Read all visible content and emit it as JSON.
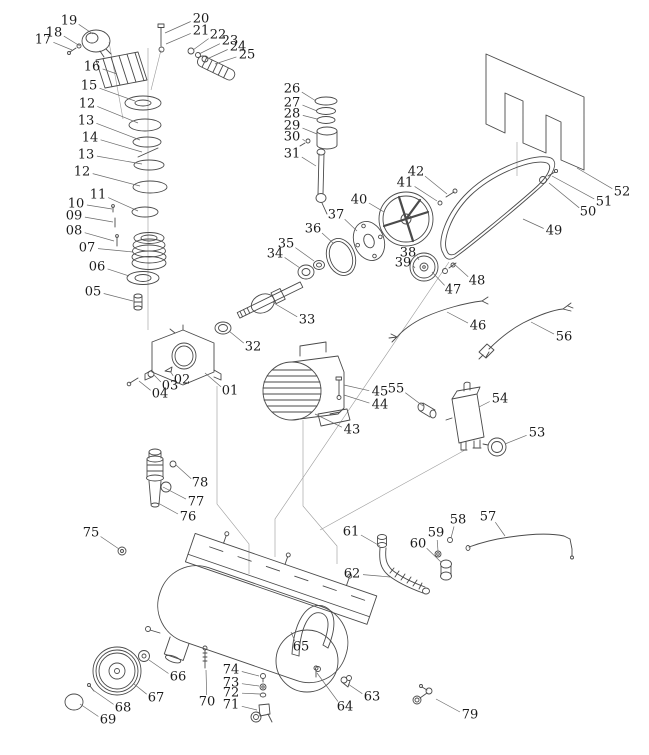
{
  "diagram": {
    "type": "exploded-parts-diagram",
    "subject": "air-compressor",
    "colors": {
      "background": "#ffffff",
      "line": "#4a4a4a",
      "construction": "#9a9a9a",
      "leader": "#6a6a6a",
      "label": "#1b1b1b"
    },
    "labels": [
      {
        "n": "17",
        "x": 43,
        "y": 40,
        "tx": 72,
        "ty": 50
      },
      {
        "n": "18",
        "x": 54,
        "y": 33,
        "tx": 80,
        "ty": 46
      },
      {
        "n": "19",
        "x": 69,
        "y": 21,
        "tx": 93,
        "ty": 34
      },
      {
        "n": "20",
        "x": 201,
        "y": 19,
        "tx": 165,
        "ty": 33
      },
      {
        "n": "21",
        "x": 201,
        "y": 31,
        "tx": 166,
        "ty": 44
      },
      {
        "n": "22",
        "x": 218,
        "y": 35,
        "tx": 193,
        "ty": 50
      },
      {
        "n": "23",
        "x": 230,
        "y": 41,
        "tx": 199,
        "ty": 54
      },
      {
        "n": "24",
        "x": 238,
        "y": 47,
        "tx": 207,
        "ty": 59
      },
      {
        "n": "25",
        "x": 247,
        "y": 55,
        "tx": 215,
        "ty": 64
      },
      {
        "n": "16",
        "x": 92,
        "y": 67,
        "tx": 117,
        "ty": 74
      },
      {
        "n": "15",
        "x": 89,
        "y": 86,
        "tx": 135,
        "ty": 101
      },
      {
        "n": "12",
        "x": 87,
        "y": 104,
        "tx": 138,
        "ty": 123
      },
      {
        "n": "13",
        "x": 86,
        "y": 121,
        "tx": 140,
        "ty": 140
      },
      {
        "n": "14",
        "x": 90,
        "y": 138,
        "tx": 142,
        "ty": 152
      },
      {
        "n": "13",
        "x": 86,
        "y": 155,
        "tx": 142,
        "ty": 164
      },
      {
        "n": "12",
        "x": 82,
        "y": 172,
        "tx": 140,
        "ty": 186
      },
      {
        "n": "11",
        "x": 98,
        "y": 195,
        "tx": 138,
        "ty": 211
      },
      {
        "n": "10",
        "x": 76,
        "y": 204,
        "tx": 112,
        "ty": 209
      },
      {
        "n": "09",
        "x": 74,
        "y": 216,
        "tx": 113,
        "ty": 222
      },
      {
        "n": "08",
        "x": 74,
        "y": 231,
        "tx": 114,
        "ty": 241
      },
      {
        "n": "07",
        "x": 87,
        "y": 248,
        "tx": 133,
        "ty": 252
      },
      {
        "n": "06",
        "x": 97,
        "y": 267,
        "tx": 129,
        "ty": 276
      },
      {
        "n": "05",
        "x": 93,
        "y": 292,
        "tx": 133,
        "ty": 301
      },
      {
        "n": "26",
        "x": 292,
        "y": 89,
        "tx": 316,
        "ty": 101
      },
      {
        "n": "27",
        "x": 292,
        "y": 103,
        "tx": 317,
        "ty": 111
      },
      {
        "n": "28",
        "x": 292,
        "y": 114,
        "tx": 317,
        "ty": 119
      },
      {
        "n": "29",
        "x": 292,
        "y": 126,
        "tx": 317,
        "ty": 134
      },
      {
        "n": "30",
        "x": 292,
        "y": 137,
        "tx": 305,
        "ty": 141
      },
      {
        "n": "31",
        "x": 292,
        "y": 154,
        "tx": 316,
        "ty": 166
      },
      {
        "n": "40",
        "x": 359,
        "y": 200,
        "tx": 384,
        "ty": 212
      },
      {
        "n": "41",
        "x": 405,
        "y": 183,
        "tx": 437,
        "ty": 201
      },
      {
        "n": "42",
        "x": 416,
        "y": 172,
        "tx": 447,
        "ty": 194
      },
      {
        "n": "37",
        "x": 336,
        "y": 215,
        "tx": 357,
        "ty": 231
      },
      {
        "n": "36",
        "x": 313,
        "y": 229,
        "tx": 333,
        "ty": 243
      },
      {
        "n": "35",
        "x": 286,
        "y": 244,
        "tx": 314,
        "ty": 261
      },
      {
        "n": "34",
        "x": 275,
        "y": 254,
        "tx": 300,
        "ty": 268
      },
      {
        "n": "33",
        "x": 307,
        "y": 320,
        "tx": 272,
        "ty": 302
      },
      {
        "n": "38",
        "x": 408,
        "y": 253,
        "tx": 419,
        "ty": 260
      },
      {
        "n": "39",
        "x": 403,
        "y": 263,
        "tx": 415,
        "ty": 268
      },
      {
        "n": "32",
        "x": 253,
        "y": 347,
        "tx": 229,
        "ty": 331
      },
      {
        "n": "50",
        "x": 588,
        "y": 212,
        "tx": 549,
        "ty": 183
      },
      {
        "n": "51",
        "x": 604,
        "y": 202,
        "tx": 552,
        "ty": 176
      },
      {
        "n": "52",
        "x": 622,
        "y": 192,
        "tx": 577,
        "ty": 168
      },
      {
        "n": "49",
        "x": 554,
        "y": 231,
        "tx": 523,
        "ty": 219
      },
      {
        "n": "48",
        "x": 477,
        "y": 281,
        "tx": 453,
        "ty": 263
      },
      {
        "n": "47",
        "x": 453,
        "y": 290,
        "tx": 432,
        "ty": 272
      },
      {
        "n": "46",
        "x": 478,
        "y": 326,
        "tx": 447,
        "ty": 312
      },
      {
        "n": "56",
        "x": 564,
        "y": 337,
        "tx": 531,
        "ty": 322
      },
      {
        "n": "45",
        "x": 380,
        "y": 392,
        "tx": 344,
        "ty": 385
      },
      {
        "n": "55",
        "x": 396,
        "y": 389,
        "tx": 423,
        "ty": 406
      },
      {
        "n": "44",
        "x": 380,
        "y": 405,
        "tx": 344,
        "ty": 395
      },
      {
        "n": "43",
        "x": 352,
        "y": 430,
        "tx": 315,
        "ty": 414
      },
      {
        "n": "54",
        "x": 500,
        "y": 399,
        "tx": 479,
        "ty": 407
      },
      {
        "n": "53",
        "x": 537,
        "y": 433,
        "tx": 505,
        "ty": 444
      },
      {
        "n": "01",
        "x": 230,
        "y": 391,
        "tx": 205,
        "ty": 373
      },
      {
        "n": "02",
        "x": 182,
        "y": 380,
        "tx": 170,
        "ty": 371
      },
      {
        "n": "03",
        "x": 170,
        "y": 386,
        "tx": 154,
        "ty": 375
      },
      {
        "n": "04",
        "x": 160,
        "y": 394,
        "tx": 139,
        "ty": 381
      },
      {
        "n": "78",
        "x": 200,
        "y": 483,
        "tx": 176,
        "ty": 465
      },
      {
        "n": "77",
        "x": 196,
        "y": 502,
        "tx": 163,
        "ty": 487
      },
      {
        "n": "76",
        "x": 188,
        "y": 517,
        "tx": 158,
        "ty": 503
      },
      {
        "n": "75",
        "x": 91,
        "y": 533,
        "tx": 119,
        "ty": 549
      },
      {
        "n": "61",
        "x": 351,
        "y": 532,
        "tx": 380,
        "ty": 546
      },
      {
        "n": "59",
        "x": 436,
        "y": 533,
        "tx": 438,
        "ty": 551
      },
      {
        "n": "60",
        "x": 418,
        "y": 544,
        "tx": 441,
        "ty": 562
      },
      {
        "n": "58",
        "x": 458,
        "y": 520,
        "tx": 451,
        "ty": 538
      },
      {
        "n": "57",
        "x": 488,
        "y": 517,
        "tx": 505,
        "ty": 536
      },
      {
        "n": "62",
        "x": 352,
        "y": 574,
        "tx": 390,
        "ty": 577
      },
      {
        "n": "65",
        "x": 301,
        "y": 647,
        "tx": 291,
        "ty": 632
      },
      {
        "n": "66",
        "x": 178,
        "y": 677,
        "tx": 149,
        "ty": 660
      },
      {
        "n": "67",
        "x": 156,
        "y": 698,
        "tx": 134,
        "ty": 684
      },
      {
        "n": "68",
        "x": 123,
        "y": 708,
        "tx": 93,
        "ty": 690
      },
      {
        "n": "69",
        "x": 108,
        "y": 720,
        "tx": 80,
        "ty": 704
      },
      {
        "n": "70",
        "x": 207,
        "y": 702,
        "tx": 206,
        "ty": 670
      },
      {
        "n": "74",
        "x": 231,
        "y": 670,
        "tx": 259,
        "ty": 676
      },
      {
        "n": "73",
        "x": 231,
        "y": 683,
        "tx": 259,
        "ty": 686
      },
      {
        "n": "72",
        "x": 231,
        "y": 693,
        "tx": 260,
        "ty": 694
      },
      {
        "n": "71",
        "x": 231,
        "y": 705,
        "tx": 257,
        "ty": 710
      },
      {
        "n": "64",
        "x": 345,
        "y": 707,
        "tx": 317,
        "ty": 673
      },
      {
        "n": "63",
        "x": 372,
        "y": 697,
        "tx": 348,
        "ty": 684
      },
      {
        "n": "79",
        "x": 470,
        "y": 715,
        "tx": 436,
        "ty": 699
      }
    ]
  }
}
